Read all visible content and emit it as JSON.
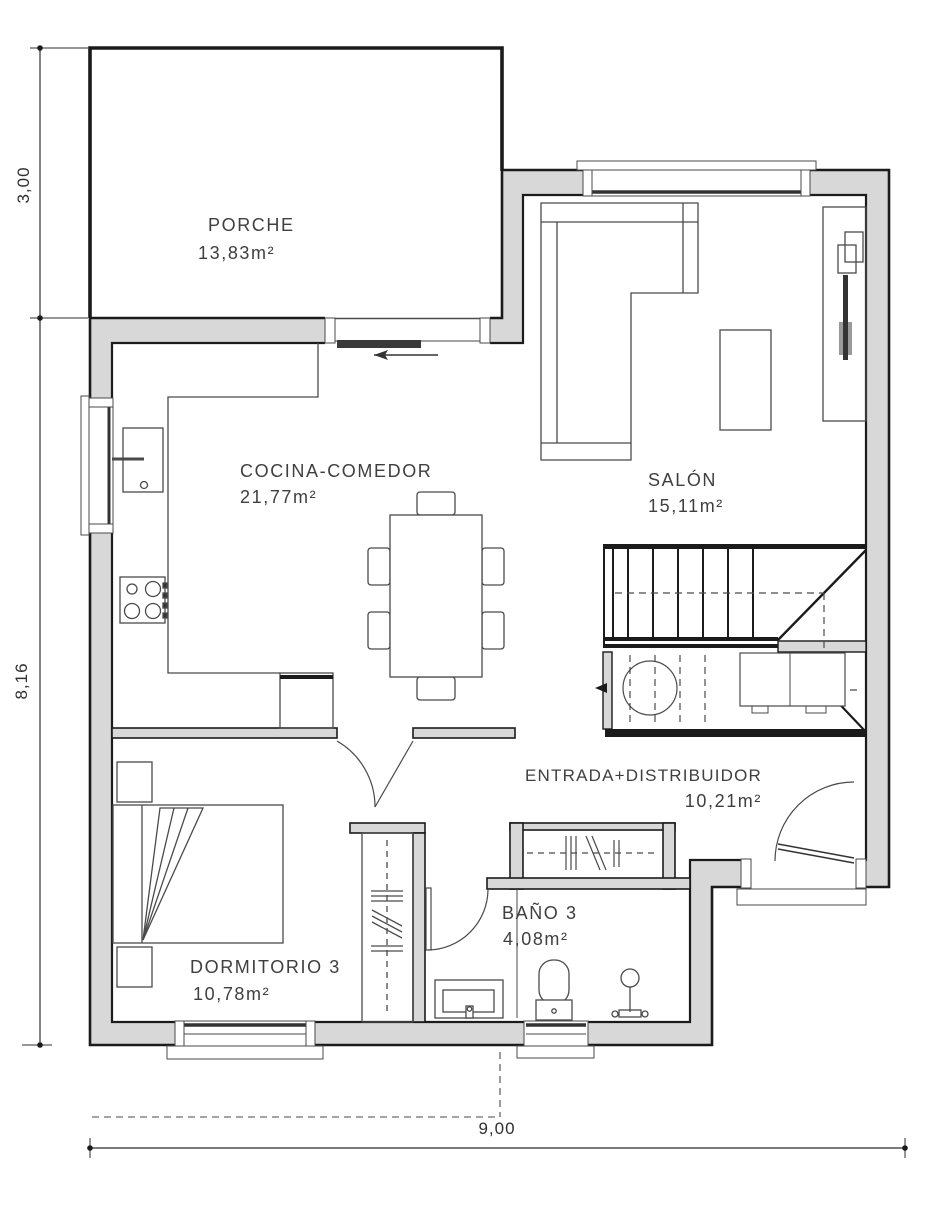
{
  "plan": {
    "title": "Planta baja - vivienda unifamiliar",
    "rooms": [
      {
        "id": "porche",
        "name": "PORCHE",
        "area": "13,83m²"
      },
      {
        "id": "cocina",
        "name": "COCINA-COMEDOR",
        "area": "21,77m²"
      },
      {
        "id": "salon",
        "name": "SALÓN",
        "area": "15,11m²"
      },
      {
        "id": "entrada",
        "name": "ENTRADA+DISTRIBUIDOR",
        "area": "10,21m²"
      },
      {
        "id": "bano",
        "name": "BAÑO 3",
        "area": "4,08m²"
      },
      {
        "id": "dorm",
        "name": "DORMITORIO 3",
        "area": "10,78m²"
      }
    ],
    "dimensions": {
      "left_top": "3,00",
      "left_bottom": "8,16",
      "bottom": "9,00"
    },
    "colors": {
      "wall_fill": "#d8d8d8",
      "wall_line": "#1b1b1b",
      "furniture_line": "#4a4a4a",
      "text": "#3f3f3f"
    }
  }
}
